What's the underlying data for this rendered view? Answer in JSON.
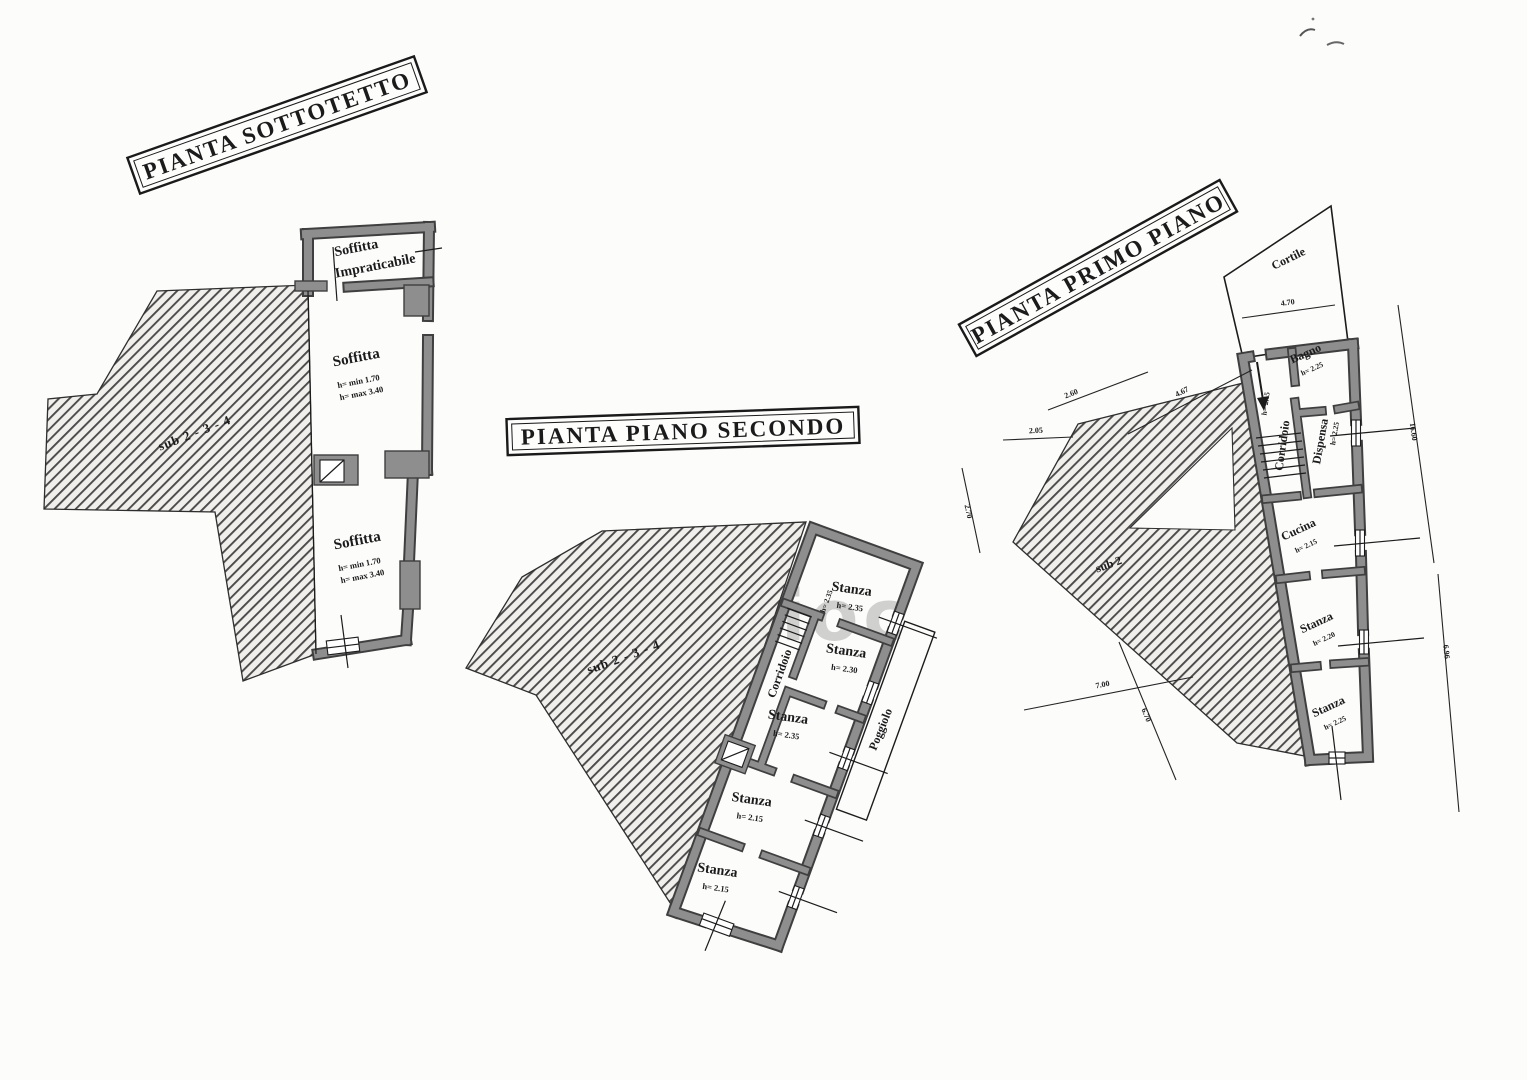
{
  "watermark": {
    "text": "studioc"
  },
  "colors": {
    "paper": "#fcfcfb",
    "wall_fill": "#8e8e8e",
    "wall_edge": "#3f3f3f",
    "hatch_line": "#4a4a4a",
    "ink": "#1b1b1b"
  },
  "plans": {
    "sottotetto": {
      "title": "PIANTA SOTTOTETTO",
      "sub_label": "sub 2 - 3 - 4",
      "rooms": {
        "top": {
          "name": "Soffitta",
          "name_line2": "Impraticabile"
        },
        "mid": {
          "name": "Soffitta",
          "h_min": "h= min 1.70",
          "h_max": "h= max 3.40"
        },
        "bottom": {
          "name": "Soffitta",
          "h_min": "h= min 1.70",
          "h_max": "h= max 3.40"
        }
      }
    },
    "secondo": {
      "title": "PIANTA PIANO SECONDO",
      "sub_label": "sub 2 - 3 - 4",
      "rooms": {
        "stanza1": {
          "name": "Stanza",
          "h": "h= 2.35"
        },
        "stanza2": {
          "name": "Stanza",
          "h": "h= 2.30"
        },
        "corridoio": {
          "name": "Corridoio",
          "h": "h= 2.35"
        },
        "stanza3": {
          "name": "Stanza",
          "h": "h= 2.35"
        },
        "stanza4": {
          "name": "Stanza",
          "h": "h= 2.15"
        },
        "stanza5": {
          "name": "Stanza",
          "h": "h= 2.15"
        },
        "poggiolo": {
          "name": "Poggiolo"
        }
      }
    },
    "primo": {
      "title": "PIANTA PRIMO PIANO",
      "sub_label": "sub 2",
      "rooms": {
        "cortile": {
          "name": "Cortile"
        },
        "bagno": {
          "name": "Bagno",
          "h": "h= 2.25"
        },
        "corridoio": {
          "name": "Corridoio",
          "h": "h= 2.15"
        },
        "dispensa": {
          "name": "Dispensa",
          "h": "h= 2.25"
        },
        "cucina": {
          "name": "Cucina",
          "h": "h= 2.15"
        },
        "stanza1": {
          "name": "Stanza",
          "h": "h= 2.20"
        },
        "stanza2": {
          "name": "Stanza",
          "h": "h= 2.25"
        }
      },
      "dimensions": {
        "cortile_width": "4.70",
        "upper_diag": "4.67",
        "small_diag": "2.60",
        "small_horiz": "2.05",
        "small_vert": "2.70",
        "bottom_horiz": "7.00",
        "bottom_diag": "6.70",
        "right_long": "16.60",
        "right_short": "6.96"
      }
    }
  }
}
